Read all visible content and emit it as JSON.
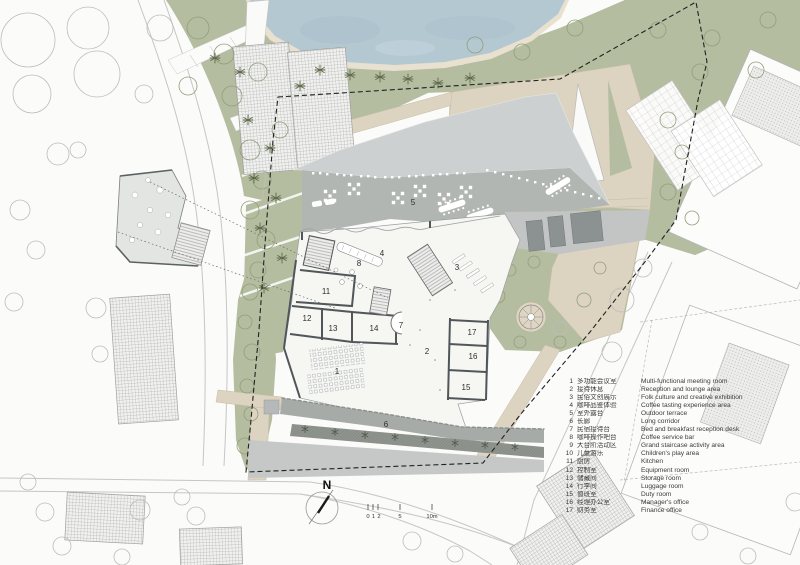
{
  "north": {
    "label": "N"
  },
  "scalebar": {
    "labels": [
      "0",
      "1",
      "2",
      "5",
      "10m"
    ]
  },
  "plan": {
    "room_labels": [
      "1",
      "2",
      "3",
      "4",
      "5",
      "6",
      "7",
      "8",
      "11",
      "12",
      "13",
      "14",
      "15",
      "16",
      "17"
    ]
  },
  "legend": {
    "items": [
      {
        "num": "1",
        "zh": "多功能会议室",
        "en": "Multi-functional meeting room"
      },
      {
        "num": "2",
        "zh": "接待休息",
        "en": "Reception and lounge area"
      },
      {
        "num": "3",
        "zh": "民俗文创展示",
        "en": "Folk culture and creative exhibition"
      },
      {
        "num": "4",
        "zh": "咖啡品鉴体验",
        "en": "Coffee tasting experience area"
      },
      {
        "num": "5",
        "zh": "室外露台",
        "en": "Outdoor terrace"
      },
      {
        "num": "6",
        "zh": "长廊",
        "en": "Long corridor"
      },
      {
        "num": "7",
        "zh": "民宿接待台",
        "en": "Bed and breakfast reception desk"
      },
      {
        "num": "8",
        "zh": "咖啡操作吧台",
        "en": "Coffee service bar"
      },
      {
        "num": "9",
        "zh": "大台阶活动区",
        "en": "Grand staircase activity area"
      },
      {
        "num": "10",
        "zh": "儿童游乐",
        "en": "Children's play area"
      },
      {
        "num": "11",
        "zh": "厨房",
        "en": "Kitchen"
      },
      {
        "num": "12",
        "zh": "控制室",
        "en": "Equipment room"
      },
      {
        "num": "13",
        "zh": "储藏间",
        "en": "Storage room"
      },
      {
        "num": "14",
        "zh": "行李间",
        "en": "Luggage room"
      },
      {
        "num": "15",
        "zh": "值班室",
        "en": "Duty room"
      },
      {
        "num": "16",
        "zh": "经理办公室",
        "en": "Manager's office"
      },
      {
        "num": "17",
        "zh": "财务室",
        "en": "Finance office"
      }
    ]
  },
  "colors": {
    "water": "#b4c8d2",
    "sand": "#e9e1d0",
    "vegetation": "#b5bda0",
    "paving_beige": "#dcd3c0",
    "roof": "#cdd0d1",
    "terrace": "#b2b6b2",
    "corridor_planting": "#8e938d",
    "boundary": "#222222"
  }
}
